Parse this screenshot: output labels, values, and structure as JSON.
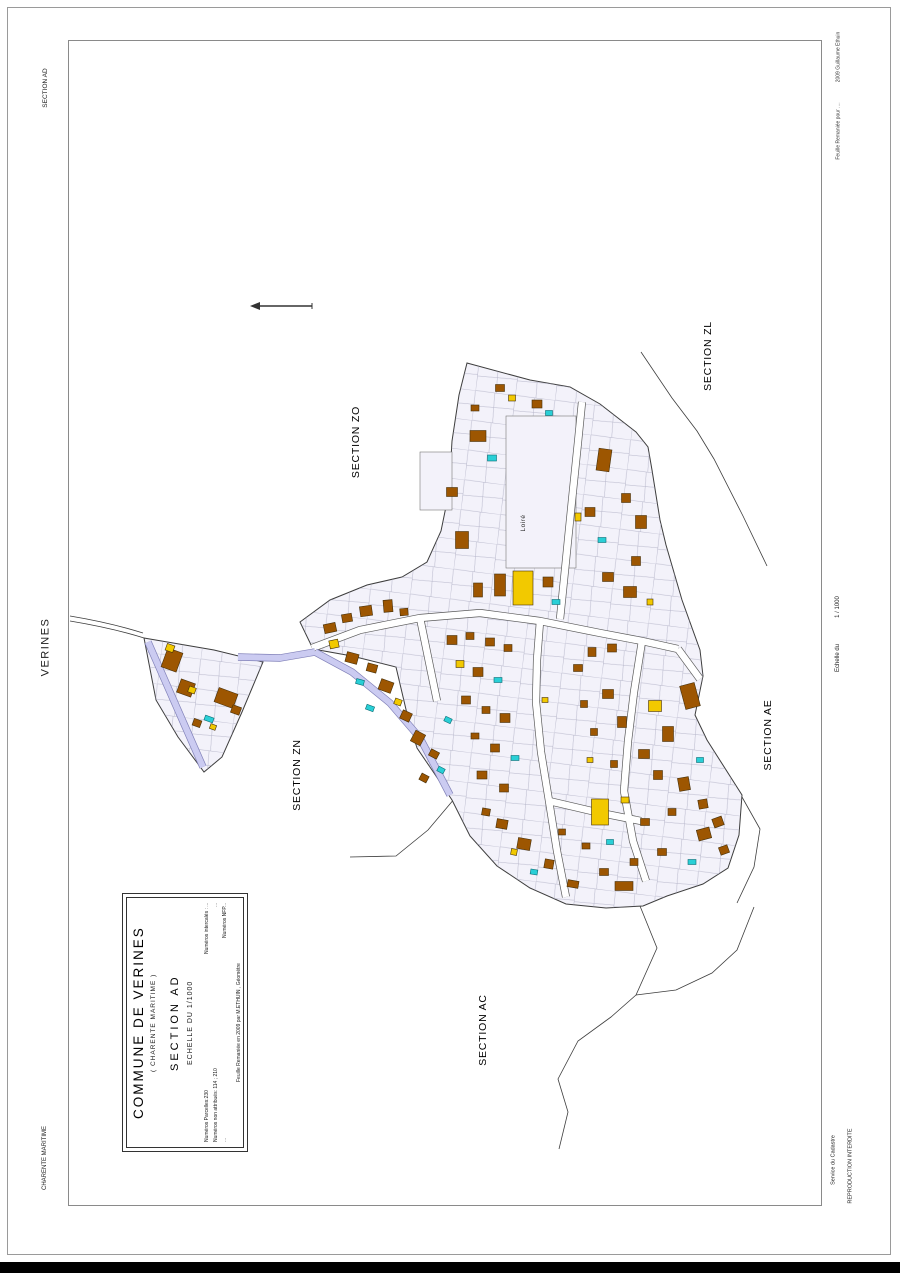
{
  "margins": {
    "top_left": "SECTION AD",
    "left": "VERINES",
    "bottom_left": "CHARENTE MARITIME",
    "right_top_upper": "2009 Guillaume Ethuin",
    "right_top_lower": "Feuille Remaniée pour ....",
    "right_middle_upper": "1 / 1000",
    "right_middle_lower": "Echelle du",
    "right_bottom_service": "Service du Cadastre",
    "right_bottom_reproduction": "REPRODUCTION INTERDITE"
  },
  "cartouche": {
    "title": "COMMUNE DE VERINES",
    "subtitle": "( CHARENTE MARITIME )",
    "section": "SECTION  AD",
    "scale": "ECHELLE  DU  1/1000",
    "numbers_rows": [
      [
        "Numéros Parcelles:230",
        "Numéros intercalés : ..."
      ],
      [
        "Numéros non attribués:  114 ; 210",
        "..."
      ],
      [
        "...",
        "Numéros NFP..."
      ]
    ],
    "footer": "Feuille Remaniée en 2009 par M.ETHUIN , Géomètre"
  },
  "map": {
    "place_label": "Loiré",
    "section_labels": [
      {
        "id": "zo",
        "text": "SECTION ZO",
        "x": 356,
        "y": 442
      },
      {
        "id": "zl",
        "text": "SECTION ZL",
        "x": 708,
        "y": 356
      },
      {
        "id": "zn",
        "text": "SECTION ZN",
        "x": 297,
        "y": 775
      },
      {
        "id": "ae",
        "text": "SECTION AE",
        "x": 768,
        "y": 735
      },
      {
        "id": "ac",
        "text": "SECTION AC",
        "x": 483,
        "y": 1030
      }
    ],
    "place_label_pos": {
      "x": 524,
      "y": 523
    },
    "colors": {
      "building": "#9d5601",
      "building_stroke": "#46300a",
      "annex": "#f2c900",
      "pool": "#29cfd6",
      "pool_stroke": "#0a6b73",
      "road_fill": "#cbcbf1",
      "road_casing": "#8080b8",
      "parcel_fill": "#f3f2fa",
      "line": "#3d3d3d",
      "parcel_line": "#a0a0b8",
      "street_fill": "#ffffff",
      "street_casing": "#5a5a5a"
    },
    "village_outline": "M 467,363 L 530,380 570,387 600,404 636,432 648,447 652,470 660,520 666,545 682,600 700,650 703,676 695,715 707,740 742,795 739,835 728,868 703,884 667,896 643,906 606,908 566,904 530,888 497,866 470,836 452,800 434,773 417,748 408,718 396,667 352,656 313,649 300,622 330,600 367,585 402,577 427,562 441,531 449,492 452,441 459,395 Z",
    "west_triangle": "M 144,638 L 214,650 263,662 242,712 222,757 204,772 178,737 156,700 Z",
    "open_areas": [
      [
        506,
        416,
        70,
        152
      ],
      [
        420,
        452,
        32,
        58
      ]
    ],
    "boundaries": [
      "M 70,621 C 100,626 125,632 144,638",
      "M 70,616 C 100,621 124,627 143,633",
      "M 641,352 L 672,398 697,431 714,459 743,516 767,566",
      "M 455,798 L 428,830 396,856 350,857",
      "M 640,906 L 657,948 636,995 611,1017 578,1041 558,1079 568,1112 559,1149",
      "M 636,995 L 676,990 712,973 737,950 754,907",
      "M 742,797 L 760,829 754,867 737,903"
    ],
    "streets": [
      "M 312,648 L 360,630 420,618 480,613 540,621 600,633 642,641 678,649",
      "M 420,618 L 429,662 437,701",
      "M 540,621 L 537,660 536,702 541,752 549,801 557,851 566,897",
      "M 642,641 L 634,692 628,741 624,791 633,841 646,881",
      "M 678,649 L 700,679",
      "M 560,619 L 566,560 572,500 578,442 582,402",
      "M 549,801 L 596,812 641,821"
    ],
    "lavender_roads": [
      "M 148,642 L 203,767",
      "M 238,657 L 280,658 315,652",
      "M 315,652 L 352,672 390,703 420,738 438,772 450,795"
    ],
    "north_arrow": {
      "x1": 258,
      "y1": 306,
      "x2": 312,
      "y2": 306
    },
    "buildings": [
      [
        172,
        660,
        16,
        20,
        20,
        "b"
      ],
      [
        170,
        648,
        8,
        7,
        20,
        "y"
      ],
      [
        186,
        688,
        15,
        14,
        20,
        "b"
      ],
      [
        192,
        690,
        7,
        6,
        20,
        "y"
      ],
      [
        226,
        698,
        20,
        15,
        20,
        "b"
      ],
      [
        236,
        710,
        9,
        8,
        20,
        "b"
      ],
      [
        209,
        719,
        9,
        5,
        20,
        "c"
      ],
      [
        213,
        727,
        6,
        5,
        20,
        "y"
      ],
      [
        197,
        723,
        8,
        7,
        20,
        "b"
      ],
      [
        330,
        628,
        12,
        9,
        -12,
        "b"
      ],
      [
        347,
        618,
        10,
        8,
        -10,
        "b"
      ],
      [
        366,
        611,
        12,
        10,
        -8,
        "b"
      ],
      [
        388,
        606,
        9,
        12,
        -5,
        "b"
      ],
      [
        404,
        612,
        8,
        7,
        -5,
        "b"
      ],
      [
        334,
        644,
        9,
        8,
        -12,
        "y"
      ],
      [
        352,
        658,
        12,
        10,
        15,
        "b"
      ],
      [
        372,
        668,
        10,
        8,
        15,
        "b"
      ],
      [
        360,
        682,
        8,
        5,
        15,
        "c"
      ],
      [
        386,
        686,
        13,
        11,
        20,
        "b"
      ],
      [
        398,
        702,
        7,
        6,
        20,
        "y"
      ],
      [
        406,
        716,
        10,
        9,
        25,
        "b"
      ],
      [
        370,
        708,
        8,
        5,
        20,
        "c"
      ],
      [
        418,
        738,
        11,
        12,
        28,
        "b"
      ],
      [
        434,
        754,
        9,
        7,
        28,
        "b"
      ],
      [
        441,
        770,
        7,
        5,
        28,
        "c"
      ],
      [
        424,
        778,
        8,
        7,
        28,
        "b"
      ],
      [
        452,
        640,
        10,
        9,
        0,
        "b"
      ],
      [
        470,
        636,
        8,
        7,
        0,
        "b"
      ],
      [
        490,
        642,
        9,
        8,
        0,
        "b"
      ],
      [
        508,
        648,
        8,
        7,
        0,
        "b"
      ],
      [
        460,
        664,
        8,
        7,
        0,
        "y"
      ],
      [
        478,
        672,
        10,
        9,
        0,
        "b"
      ],
      [
        498,
        680,
        8,
        5,
        0,
        "c"
      ],
      [
        466,
        700,
        9,
        8,
        0,
        "b"
      ],
      [
        486,
        710,
        8,
        7,
        0,
        "b"
      ],
      [
        505,
        718,
        10,
        9,
        0,
        "b"
      ],
      [
        475,
        736,
        8,
        6,
        0,
        "b"
      ],
      [
        495,
        748,
        9,
        8,
        0,
        "b"
      ],
      [
        515,
        758,
        8,
        5,
        0,
        "c"
      ],
      [
        482,
        775,
        10,
        8,
        0,
        "b"
      ],
      [
        504,
        788,
        9,
        8,
        0,
        "b"
      ],
      [
        523,
        588,
        20,
        34,
        0,
        "y"
      ],
      [
        500,
        585,
        11,
        22,
        0,
        "b"
      ],
      [
        478,
        590,
        9,
        14,
        0,
        "b"
      ],
      [
        548,
        582,
        10,
        10,
        0,
        "b"
      ],
      [
        556,
        602,
        8,
        5,
        0,
        "c"
      ],
      [
        478,
        436,
        16,
        11,
        0,
        "b"
      ],
      [
        492,
        458,
        9,
        6,
        0,
        "c"
      ],
      [
        452,
        492,
        11,
        9,
        0,
        "b"
      ],
      [
        462,
        540,
        13,
        17,
        0,
        "b"
      ],
      [
        537,
        404,
        10,
        8,
        0,
        "b"
      ],
      [
        549,
        413,
        7,
        5,
        0,
        "c"
      ],
      [
        604,
        460,
        13,
        22,
        8,
        "b"
      ],
      [
        590,
        512,
        10,
        9,
        0,
        "b"
      ],
      [
        602,
        540,
        8,
        5,
        0,
        "c"
      ],
      [
        626,
        498,
        9,
        9,
        0,
        "b"
      ],
      [
        641,
        522,
        11,
        13,
        0,
        "b"
      ],
      [
        636,
        561,
        9,
        9,
        0,
        "b"
      ],
      [
        578,
        517,
        6,
        8,
        0,
        "y"
      ],
      [
        608,
        577,
        11,
        9,
        0,
        "b"
      ],
      [
        630,
        592,
        13,
        11,
        0,
        "b"
      ],
      [
        650,
        602,
        6,
        6,
        0,
        "y"
      ],
      [
        512,
        398,
        7,
        6,
        0,
        "y"
      ],
      [
        500,
        388,
        9,
        7,
        0,
        "b"
      ],
      [
        475,
        408,
        8,
        6,
        0,
        "b"
      ],
      [
        592,
        652,
        8,
        9,
        0,
        "b"
      ],
      [
        612,
        648,
        9,
        8,
        0,
        "b"
      ],
      [
        578,
        668,
        9,
        7,
        0,
        "b"
      ],
      [
        608,
        694,
        11,
        9,
        0,
        "b"
      ],
      [
        584,
        704,
        7,
        7,
        0,
        "b"
      ],
      [
        622,
        722,
        9,
        11,
        0,
        "b"
      ],
      [
        594,
        732,
        7,
        7,
        0,
        "b"
      ],
      [
        655,
        706,
        13,
        11,
        0,
        "y"
      ],
      [
        690,
        696,
        15,
        24,
        -15,
        "b"
      ],
      [
        668,
        734,
        11,
        15,
        0,
        "b"
      ],
      [
        644,
        754,
        11,
        9,
        0,
        "b"
      ],
      [
        614,
        764,
        7,
        7,
        0,
        "b"
      ],
      [
        658,
        775,
        9,
        9,
        0,
        "b"
      ],
      [
        684,
        784,
        11,
        13,
        -10,
        "b"
      ],
      [
        703,
        804,
        9,
        9,
        -10,
        "b"
      ],
      [
        672,
        812,
        8,
        7,
        0,
        "b"
      ],
      [
        645,
        822,
        9,
        7,
        0,
        "b"
      ],
      [
        704,
        834,
        13,
        11,
        -15,
        "b"
      ],
      [
        692,
        862,
        8,
        5,
        0,
        "c"
      ],
      [
        662,
        852,
        9,
        7,
        0,
        "b"
      ],
      [
        634,
        862,
        8,
        7,
        0,
        "b"
      ],
      [
        604,
        872,
        9,
        7,
        0,
        "b"
      ],
      [
        600,
        812,
        17,
        26,
        0,
        "y"
      ],
      [
        625,
        800,
        8,
        6,
        0,
        "y"
      ],
      [
        718,
        822,
        10,
        9,
        -20,
        "b"
      ],
      [
        724,
        850,
        9,
        8,
        -20,
        "b"
      ],
      [
        700,
        760,
        7,
        5,
        0,
        "c"
      ],
      [
        590,
        760,
        6,
        5,
        0,
        "y"
      ],
      [
        502,
        824,
        11,
        9,
        10,
        "b"
      ],
      [
        524,
        844,
        13,
        11,
        10,
        "b"
      ],
      [
        549,
        864,
        9,
        9,
        10,
        "b"
      ],
      [
        573,
        884,
        11,
        7,
        10,
        "b"
      ],
      [
        534,
        872,
        7,
        5,
        10,
        "c"
      ],
      [
        514,
        852,
        6,
        6,
        10,
        "y"
      ],
      [
        486,
        812,
        8,
        7,
        10,
        "b"
      ],
      [
        624,
        886,
        18,
        9,
        0,
        "b"
      ],
      [
        586,
        846,
        8,
        6,
        0,
        "b"
      ],
      [
        562,
        832,
        7,
        6,
        0,
        "b"
      ],
      [
        610,
        842,
        7,
        5,
        0,
        "c"
      ],
      [
        545,
        700,
        6,
        5,
        0,
        "y"
      ],
      [
        448,
        720,
        7,
        5,
        25,
        "c"
      ]
    ]
  }
}
